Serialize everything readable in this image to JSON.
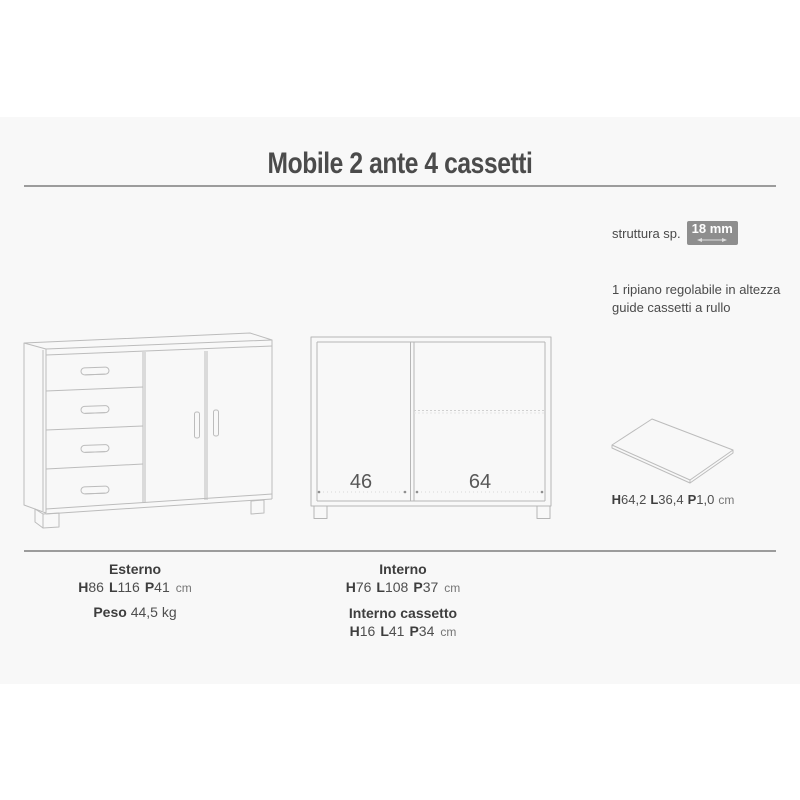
{
  "page": {
    "title": "Mobile 2 ante 4 cassetti"
  },
  "specs_top": {
    "struttura_label": "struttura sp.",
    "struttura_value": "18 mm",
    "notes": [
      "1 ripiano regolabile in altezza",
      "guide cassetti a rullo"
    ]
  },
  "front_view": {
    "left_width": "46",
    "right_width": "64"
  },
  "shelf": {
    "dims": [
      {
        "k": "H",
        "v": "64,2"
      },
      {
        "k": "L",
        "v": "36,4"
      },
      {
        "k": "P",
        "v": "1,0"
      }
    ],
    "unit": "cm"
  },
  "specs_bottom": {
    "esterno": {
      "title": "Esterno",
      "dims": [
        {
          "k": "H",
          "v": "86"
        },
        {
          "k": "L",
          "v": "116"
        },
        {
          "k": "P",
          "v": "41"
        }
      ],
      "unit": "cm"
    },
    "peso": {
      "label": "Peso",
      "value": "44,5 kg"
    },
    "interno": {
      "title": "Interno",
      "dims": [
        {
          "k": "H",
          "v": "76"
        },
        {
          "k": "L",
          "v": "108"
        },
        {
          "k": "P",
          "v": "37"
        }
      ],
      "unit": "cm"
    },
    "interno_cassetto": {
      "title": "Interno cassetto",
      "dims": [
        {
          "k": "H",
          "v": "16"
        },
        {
          "k": "L",
          "v": "41"
        },
        {
          "k": "P",
          "v": "34"
        }
      ],
      "unit": "cm"
    }
  },
  "colors": {
    "band_bg": "#f8f8f8",
    "rule": "#9c9c9c",
    "badge_bg": "#8e8e8e",
    "drawing_stroke": "#bcbcbc",
    "text": "#4a4a4a"
  }
}
